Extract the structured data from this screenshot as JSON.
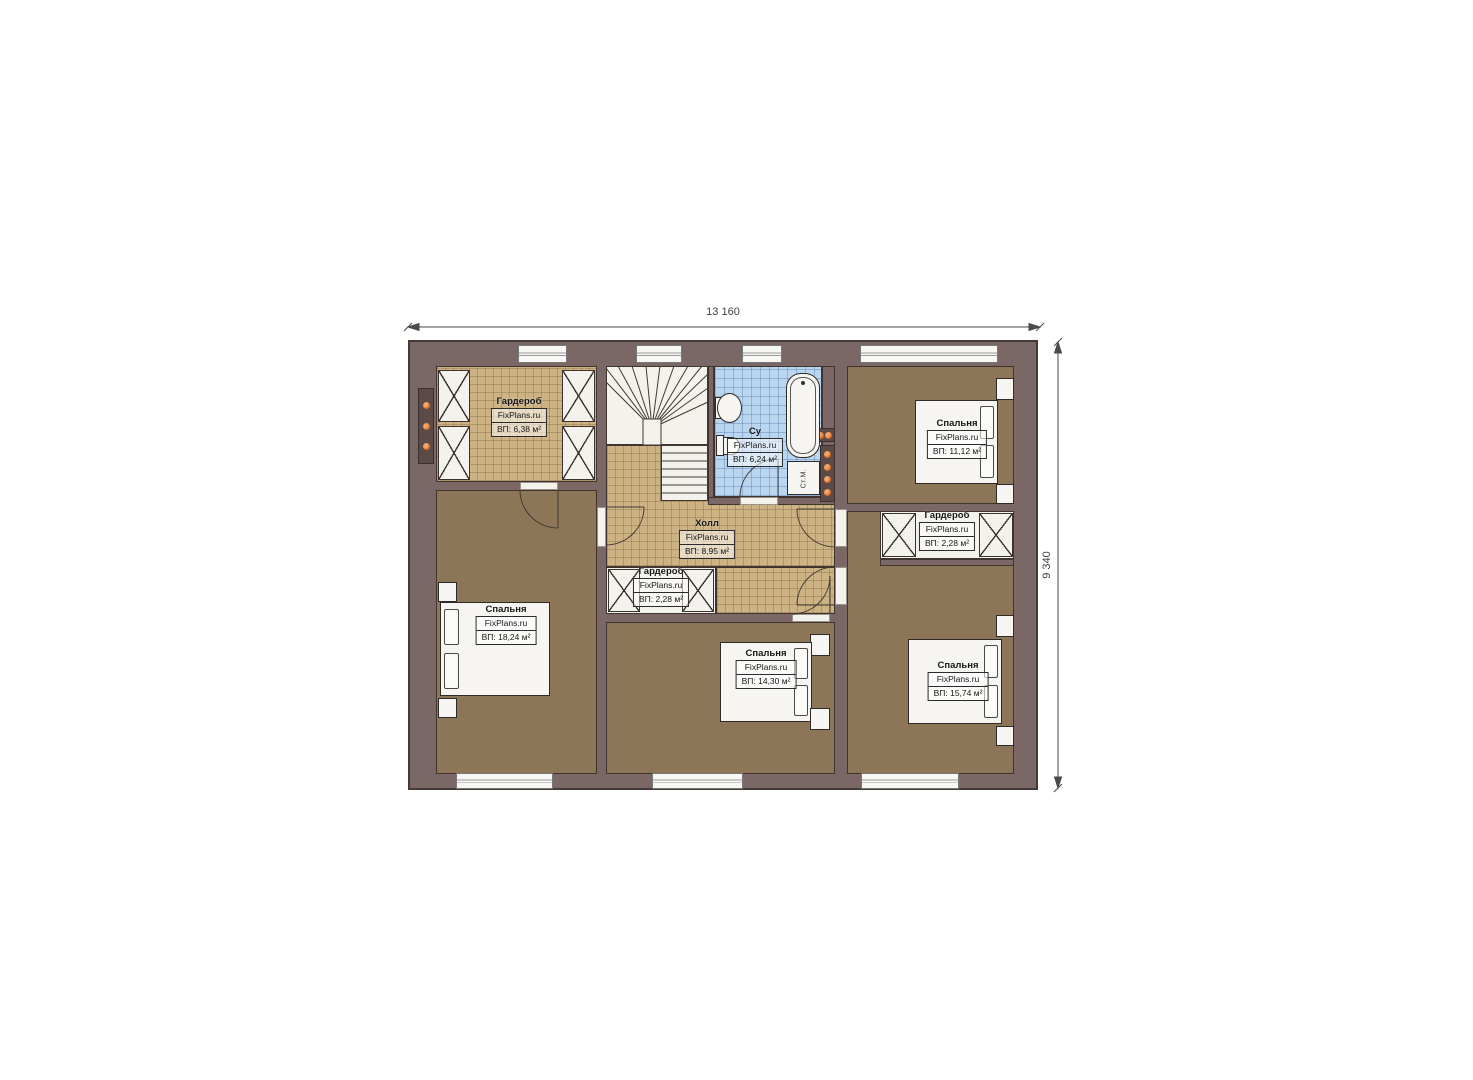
{
  "plan": {
    "watermark": "FixPlans.ru",
    "dimensions": {
      "width_label": "13 160",
      "height_label": "9 340"
    },
    "rooms": [
      {
        "name": "Гардероб",
        "area": "ВП: 6,38 м²"
      },
      {
        "name": "Су",
        "area": "ВП: 6,24 м²"
      },
      {
        "name": "Холл",
        "area": "ВП: 8,95 м²"
      },
      {
        "name": "Спальня",
        "area": "ВП: 11,12 м²"
      },
      {
        "name": "Гардероб",
        "area": "ВП: 2,28 м²"
      },
      {
        "name": "Гардероб",
        "area": "ВП: 2,28 м²"
      },
      {
        "name": "Спальня",
        "area": "ВП: 18,24 м²"
      },
      {
        "name": "Спальня",
        "area": "ВП: 14,30 м²"
      },
      {
        "name": "Спальня",
        "area": "ВП: 15,74 м²"
      }
    ],
    "fixtures": {
      "washing_machine": "Ст.М."
    },
    "colors": {
      "wall": "#7b6765",
      "bedroom_floor": "#8d7557",
      "tile_floor": "#cdb283",
      "bathroom_floor": "#b9d5f0",
      "radiator": "#e0732c"
    }
  }
}
